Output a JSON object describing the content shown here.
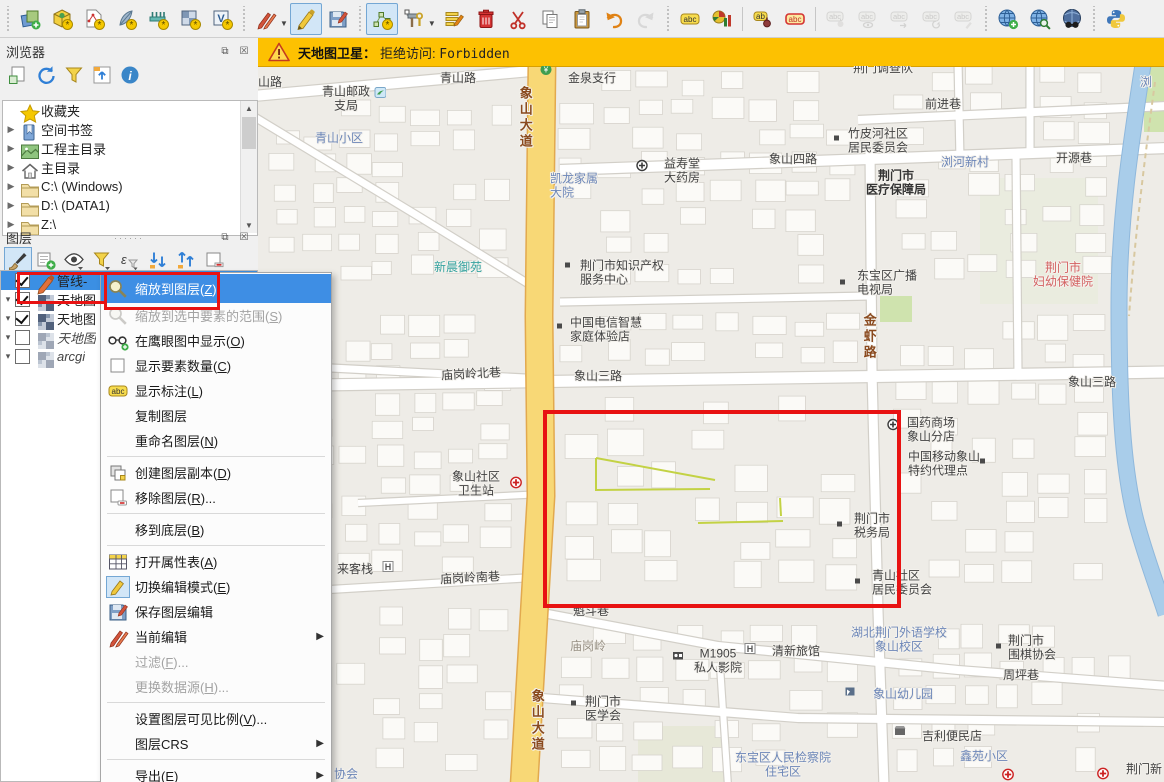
{
  "warning": {
    "title": "天地图卫星：",
    "message_prefix": "拒绝访问: ",
    "message_code": "Forbidden"
  },
  "colors": {
    "warning_bg": "#fdc101",
    "selection_blue": "#3b8fe3",
    "menu_highlight": "#3e8ee4",
    "annotation_red": "#e81212",
    "road_yellow": "#f8d876",
    "road_yellow_casing": "#e2a94e",
    "pipeline_green": "#c3d244",
    "river_blue": "#a9cdea",
    "park_green": "#cfe3ae"
  },
  "toolbar": {
    "items": [
      {
        "h": true
      },
      {
        "n": "data-source-manager-icon"
      },
      {
        "n": "new-geopackage-layer-icon"
      },
      {
        "n": "new-shapefile-layer-icon"
      },
      {
        "n": "new-spatialite-layer-icon"
      },
      {
        "n": "new-mesh-layer-icon"
      },
      {
        "n": "new-virtual-raster-icon"
      },
      {
        "n": "new-virtual-layer-icon"
      },
      {
        "h": true
      },
      {
        "n": "current-edits-icon"
      },
      {
        "caret": true
      },
      {
        "n": "toggle-editing-icon",
        "state": "pressed"
      },
      {
        "n": "save-layer-edits-icon"
      },
      {
        "h": true
      },
      {
        "n": "add-line-feature-icon",
        "state": "pressed"
      },
      {
        "n": "vertex-tool-icon"
      },
      {
        "caret": true
      },
      {
        "n": "modify-attributes-icon"
      },
      {
        "n": "delete-selected-icon"
      },
      {
        "n": "cut-features-icon"
      },
      {
        "n": "copy-features-icon"
      },
      {
        "n": "paste-features-icon"
      },
      {
        "n": "undo-icon"
      },
      {
        "n": "redo-icon",
        "state": "disabled"
      },
      {
        "h": true
      },
      {
        "n": "layer-labeling-icon"
      },
      {
        "n": "layer-diagram-icon"
      },
      {
        "s": true
      },
      {
        "n": "pin-labels-icon"
      },
      {
        "n": "highlight-pinned-labels-icon"
      },
      {
        "s": true
      },
      {
        "n": "pin-unpin-labels-icon",
        "state": "disabled"
      },
      {
        "n": "show-hide-labels-icon",
        "state": "disabled"
      },
      {
        "n": "move-label-icon",
        "state": "disabled"
      },
      {
        "n": "rotate-label-icon",
        "state": "disabled"
      },
      {
        "n": "change-label-icon",
        "state": "disabled"
      },
      {
        "h": true
      },
      {
        "n": "metasearch-add-icon"
      },
      {
        "n": "metasearch-zoom-icon"
      },
      {
        "n": "metasearch-icon"
      },
      {
        "h": true
      },
      {
        "n": "python-console-icon"
      }
    ]
  },
  "browser_panel": {
    "title": "浏览器",
    "toolbar": [
      "add-selected-layers-icon",
      "refresh-icon",
      "filter-browser-icon",
      "collapse-all-icon",
      "properties-info-icon"
    ],
    "items": [
      {
        "label": "收藏夹",
        "icon": "star",
        "expander": false
      },
      {
        "label": "空间书签",
        "icon": "bookmark",
        "expander": true
      },
      {
        "label": "工程主目录",
        "icon": "project-home",
        "expander": true
      },
      {
        "label": "主目录",
        "icon": "home",
        "expander": true
      },
      {
        "label": "C:\\ (Windows)",
        "icon": "folder",
        "expander": true
      },
      {
        "label": "D:\\ (DATA1)",
        "icon": "folder",
        "expander": true
      },
      {
        "label": "Z:\\",
        "icon": "folder",
        "expander": true
      }
    ]
  },
  "layers_panel": {
    "title": "图层",
    "toolbar": [
      "open-layer-styling-icon",
      "add-group-icon",
      "manage-map-themes-icon",
      "filter-legend-icon",
      "filter-expression-icon",
      "expand-all-icon",
      "collapse-all-layers-icon",
      "remove-layer-icon"
    ],
    "layers": [
      {
        "name": "管线-",
        "checked": true,
        "icon": "pencil",
        "selected": true,
        "expander": false
      },
      {
        "name": "天地图",
        "checked": true,
        "icon": "raster",
        "expander": true
      },
      {
        "name": "天地图",
        "checked": true,
        "icon": "raster",
        "expander": true
      },
      {
        "name": "天地图",
        "checked": false,
        "icon": "raster",
        "italic": true,
        "expander": true,
        "dim": true
      },
      {
        "name": "arcgi",
        "checked": false,
        "icon": "raster",
        "italic": true,
        "expander": true,
        "dim": true
      }
    ]
  },
  "context_menu": {
    "items": [
      {
        "name": "zoom-to-layer",
        "label": "缩放到图层(Z)",
        "icon": "zoom",
        "highlight": true
      },
      {
        "name": "zoom-to-selection",
        "label": "缩放到选中要素的范围(S)",
        "icon": "zoom",
        "disabled": true
      },
      {
        "name": "show-in-overview",
        "label": "在鹰眼图中显示(O)",
        "icon": "overview"
      },
      {
        "name": "show-feature-count",
        "label": "显示要素数量(C)",
        "icon": "checkbox"
      },
      {
        "name": "show-labels",
        "label": "显示标注(L)",
        "icon": "abc"
      },
      {
        "name": "copy-layer",
        "label": "复制图层"
      },
      {
        "name": "rename-layer",
        "label": "重命名图层(N)"
      },
      {
        "sep": true
      },
      {
        "name": "duplicate-layer",
        "label": "创建图层副本(D)",
        "icon": "dup"
      },
      {
        "name": "remove-layer",
        "label": "移除图层(R)...",
        "icon": "removelayer"
      },
      {
        "sep": true
      },
      {
        "name": "move-to-bottom",
        "label": "移到底层(B)"
      },
      {
        "sep": true
      },
      {
        "name": "open-attribute-table",
        "label": "打开属性表(A)",
        "icon": "table"
      },
      {
        "name": "toggle-editing",
        "label": "切换编辑模式(E)",
        "icon": "pencilbox"
      },
      {
        "name": "save-layer-edits",
        "label": "保存图层编辑",
        "icon": "saveedit"
      },
      {
        "name": "current-edits",
        "label": "当前编辑",
        "icon": "redpencils",
        "sub": true
      },
      {
        "name": "filter",
        "label": "过滤(F)...",
        "disabled": true
      },
      {
        "name": "change-data-source",
        "label": "更换数据源(H)...",
        "disabled": true
      },
      {
        "sep": true
      },
      {
        "name": "set-scale-visibility",
        "label": "设置图层可见比例(V)..."
      },
      {
        "name": "layer-crs",
        "label": "图层CRS",
        "sub": true
      },
      {
        "sep": true
      },
      {
        "name": "export",
        "label": "导出(E)",
        "sub": true
      },
      {
        "name": "styles",
        "label": "样式",
        "sub": true
      }
    ]
  },
  "annotations": {
    "layer_box": {
      "x": 17,
      "y": 272,
      "w": 84,
      "h": 26
    },
    "menu_box": {
      "x": 104,
      "y": 272,
      "w": 110,
      "h": 32
    },
    "map_box": {
      "x": 285,
      "y": 344,
      "w": 358,
      "h": 198
    }
  },
  "map": {
    "greens": [
      {
        "x": 886,
        "y": 0,
        "w": 20,
        "h": 66,
        "f": "#cfe3ae"
      },
      {
        "x": 622,
        "y": 230,
        "w": 32,
        "h": 26,
        "f": "#cfe3ae"
      },
      {
        "x": 722,
        "y": 112,
        "w": 118,
        "h": 126,
        "f": "#eaecdf"
      },
      {
        "x": 380,
        "y": 660,
        "w": 90,
        "h": 56,
        "f": "#e7e8d8"
      }
    ],
    "building_zones": [
      {
        "x": 8,
        "y": 34,
        "w": 246,
        "h": 180,
        "c": 7,
        "r": 7,
        "seed": 11
      },
      {
        "x": 6,
        "y": 246,
        "w": 248,
        "h": 262,
        "c": 7,
        "r": 10,
        "seed": 23
      },
      {
        "x": 6,
        "y": 540,
        "w": 250,
        "h": 166,
        "c": 7,
        "r": 6,
        "seed": 37
      },
      {
        "x": 298,
        "y": 4,
        "w": 306,
        "h": 216,
        "c": 8,
        "r": 8,
        "seed": 41
      },
      {
        "x": 298,
        "y": 246,
        "w": 308,
        "h": 54,
        "c": 8,
        "r": 2,
        "seed": 53
      },
      {
        "x": 300,
        "y": 330,
        "w": 300,
        "h": 196,
        "c": 7,
        "r": 6,
        "seed": 67
      },
      {
        "x": 296,
        "y": 556,
        "w": 310,
        "h": 150,
        "c": 8,
        "r": 5,
        "seed": 71
      },
      {
        "x": 634,
        "y": 0,
        "w": 220,
        "h": 214,
        "c": 6,
        "r": 8,
        "seed": 83
      },
      {
        "x": 634,
        "y": 246,
        "w": 216,
        "h": 278,
        "c": 6,
        "r": 9,
        "seed": 97
      },
      {
        "x": 632,
        "y": 556,
        "w": 246,
        "h": 150,
        "c": 7,
        "r": 5,
        "seed": 7
      }
    ],
    "roads_white": [
      {
        "d": "M-5,30 L284,4",
        "w": 10
      },
      {
        "d": "M-5,50 L160,150 L282,225",
        "w": 7
      },
      {
        "d": "M302,104 L640,92 L910,82",
        "w": 10
      },
      {
        "d": "M600,54 L910,40",
        "w": 8
      },
      {
        "d": "M700,-5 L702,94",
        "w": 7
      },
      {
        "d": "M772,-5 L772,86",
        "w": 7
      },
      {
        "d": "M758,86 L760,308",
        "w": 7
      },
      {
        "d": "M302,236 L612,230",
        "w": 7
      },
      {
        "d": "M-5,320 L910,306",
        "w": 11
      },
      {
        "d": "M-5,298 L267,312",
        "w": 7
      },
      {
        "d": "M612,84 L614,306 L620,545 L626,720",
        "w": 9
      },
      {
        "d": "M100,437 L286,428",
        "w": 6
      },
      {
        "d": "M-5,528 L267,512",
        "w": 7
      },
      {
        "d": "M290,548 L460,580 L700,604 L910,620",
        "w": 8
      },
      {
        "d": "M284,632 L540,652 L910,656",
        "w": 8
      },
      {
        "d": "M462,600 L470,720",
        "w": 6
      }
    ],
    "roads_yellow": [
      {
        "d": "M284,-5 L281,250 L283,430 L266,720",
        "w": 26
      }
    ],
    "river": {
      "d": "M886,-8 C874,70 861,150 861,240 C861,330 864,400 878,455 C888,492 899,520 908,548",
      "w": 15
    },
    "trail": {
      "d": "M897,16 C887,90 877,170 871,250",
      "w": 2
    },
    "pipelines": [
      [
        [
          338,
          392
        ],
        [
          338,
          424
        ],
        [
          452,
          423
        ]
      ],
      [
        [
          338,
          392
        ],
        [
          457,
          414
        ]
      ],
      [
        [
          522,
          432
        ],
        [
          523,
          450
        ]
      ],
      [
        [
          440,
          457
        ],
        [
          525,
          455
        ]
      ]
    ],
    "labels": [
      {
        "t": "山路",
        "x": 12,
        "y": 16,
        "cls": "c-road"
      },
      {
        "t": "青山邮政\n支局",
        "x": 88,
        "y": 33,
        "cls": "c-road"
      },
      {
        "t": "青山路",
        "x": 200,
        "y": 12,
        "cls": "c-road"
      },
      {
        "t": "青山小区",
        "x": 81,
        "y": 72,
        "cls": "c-blue"
      },
      {
        "t": "象山大道",
        "x": 267,
        "y": 52,
        "cls": "c-roadv"
      },
      {
        "t": "金泉支行",
        "x": 334,
        "y": 12,
        "cls": "c-road"
      },
      {
        "t": "益寿堂\n大药房",
        "x": 424,
        "y": 105,
        "cls": "c-road"
      },
      {
        "t": "凯龙家属\n大院",
        "x": 292,
        "y": 120,
        "cls": "c-blue",
        "align": "l"
      },
      {
        "t": "新晨御苑",
        "x": 200,
        "y": 201,
        "cls": "c-teal"
      },
      {
        "t": "荆门市知识产权\n服务中心",
        "x": 322,
        "y": 207,
        "cls": "c-road",
        "align": "l"
      },
      {
        "t": "荆门调查队",
        "x": 625,
        "y": 2,
        "cls": "c-road"
      },
      {
        "t": "前进巷",
        "x": 685,
        "y": 38,
        "cls": "c-road"
      },
      {
        "t": "竹皮河社区\n居民委员会",
        "x": 590,
        "y": 75,
        "cls": "c-road",
        "align": "l"
      },
      {
        "t": "象山四路",
        "x": 535,
        "y": 93,
        "cls": "c-road"
      },
      {
        "t": "浏河新村",
        "x": 707,
        "y": 96,
        "cls": "c-blue"
      },
      {
        "t": "开源巷",
        "x": 816,
        "y": 92,
        "cls": "c-road"
      },
      {
        "t": "荆门市\n医疗保障局",
        "x": 638,
        "y": 117,
        "cls": "c-bold"
      },
      {
        "t": "东宝区广播\n电视局",
        "x": 599,
        "y": 217,
        "cls": "c-road",
        "align": "l"
      },
      {
        "t": "荆门市\n妇幼保健院",
        "x": 805,
        "y": 209,
        "cls": "c-red"
      },
      {
        "t": "浏",
        "x": 888,
        "y": 16,
        "cls": "c-blue"
      },
      {
        "t": "象山三路",
        "x": 340,
        "y": 310,
        "cls": "c-road"
      },
      {
        "t": "象山三路",
        "x": 834,
        "y": 316,
        "cls": "c-road"
      },
      {
        "t": "金虾路",
        "x": 611,
        "y": 271,
        "cls": "c-roadv"
      },
      {
        "t": "中国电信智慧\n家庭体验店",
        "x": 312,
        "y": 264,
        "cls": "c-road",
        "align": "l"
      },
      {
        "t": "庙岗岭北巷",
        "x": 213,
        "y": 308,
        "cls": "c-road",
        "rot": -3
      },
      {
        "t": "象山社区\n卫生站",
        "x": 218,
        "y": 418,
        "cls": "c-road"
      },
      {
        "t": "国药商场\n象山分店",
        "x": 649,
        "y": 364,
        "cls": "c-road",
        "align": "l"
      },
      {
        "t": "中国移动象山\n特约代理点",
        "x": 650,
        "y": 398,
        "cls": "c-road",
        "align": "l"
      },
      {
        "t": "荆门市\n税务局",
        "x": 596,
        "y": 460,
        "cls": "c-road",
        "align": "l"
      },
      {
        "t": "来客栈",
        "x": 97,
        "y": 503,
        "cls": "c-road"
      },
      {
        "t": "庙岗岭南巷",
        "x": 212,
        "y": 512,
        "cls": "c-road",
        "rot": -3
      },
      {
        "t": "青山社区\n居民委员会",
        "x": 614,
        "y": 517,
        "cls": "c-road",
        "align": "l"
      },
      {
        "t": "魁斗巷",
        "x": 333,
        "y": 545,
        "cls": "c-road"
      },
      {
        "t": "庙岗岭",
        "x": 330,
        "y": 580,
        "cls": "c-gray"
      },
      {
        "t": "M1905\n私人影院",
        "x": 460,
        "y": 595,
        "cls": "c-road"
      },
      {
        "t": "清新旅馆",
        "x": 538,
        "y": 585,
        "cls": "c-road"
      },
      {
        "t": "湖北荆门外语学校\n象山校区",
        "x": 641,
        "y": 574,
        "cls": "c-blue"
      },
      {
        "t": "象山幼儿园",
        "x": 645,
        "y": 628,
        "cls": "c-blue"
      },
      {
        "t": "荆门市\n医学会",
        "x": 327,
        "y": 643,
        "cls": "c-road",
        "align": "l"
      },
      {
        "t": "象山大道",
        "x": 279,
        "y": 655,
        "cls": "c-roadv"
      },
      {
        "t": "东宝区人民检察院\n住宅区",
        "x": 525,
        "y": 699,
        "cls": "c-blue"
      },
      {
        "t": "吉利便民店",
        "x": 694,
        "y": 670,
        "cls": "c-road"
      },
      {
        "t": "荆门市\n围棋协会",
        "x": 750,
        "y": 582,
        "cls": "c-road",
        "align": "l"
      },
      {
        "t": "周坪巷",
        "x": 763,
        "y": 609,
        "cls": "c-road"
      },
      {
        "t": "鑫苑小区",
        "x": 726,
        "y": 690,
        "cls": "c-blue"
      },
      {
        "t": "协会",
        "x": 88,
        "y": 708,
        "cls": "c-blue"
      },
      {
        "t": "荆门新",
        "x": 886,
        "y": 703,
        "cls": "c-road"
      }
    ],
    "marks": [
      {
        "n": "postal",
        "x": 122,
        "y": 28
      },
      {
        "n": "bank",
        "x": 288,
        "y": 5
      },
      {
        "n": "cross-dark",
        "x": 384,
        "y": 101
      },
      {
        "n": "dot",
        "x": 310,
        "y": 201
      },
      {
        "n": "dot",
        "x": 579,
        "y": 74
      },
      {
        "n": "dot",
        "x": 302,
        "y": 262
      },
      {
        "n": "dot",
        "x": 585,
        "y": 218
      },
      {
        "n": "cross-dark",
        "x": 635,
        "y": 360
      },
      {
        "n": "dot",
        "x": 725,
        "y": 397
      },
      {
        "n": "cross-red",
        "x": 258,
        "y": 418
      },
      {
        "n": "dot",
        "x": 582,
        "y": 460
      },
      {
        "n": "hotel",
        "x": 130,
        "y": 502
      },
      {
        "n": "dot",
        "x": 600,
        "y": 517
      },
      {
        "n": "cinema",
        "x": 420,
        "y": 591
      },
      {
        "n": "hotel",
        "x": 492,
        "y": 584
      },
      {
        "n": "school",
        "x": 592,
        "y": 627
      },
      {
        "n": "dot",
        "x": 316,
        "y": 639
      },
      {
        "n": "store",
        "x": 642,
        "y": 666
      },
      {
        "n": "dot",
        "x": 741,
        "y": 582
      },
      {
        "n": "cross-red",
        "x": 750,
        "y": 710
      },
      {
        "n": "cross-red",
        "x": 845,
        "y": 709
      }
    ]
  }
}
